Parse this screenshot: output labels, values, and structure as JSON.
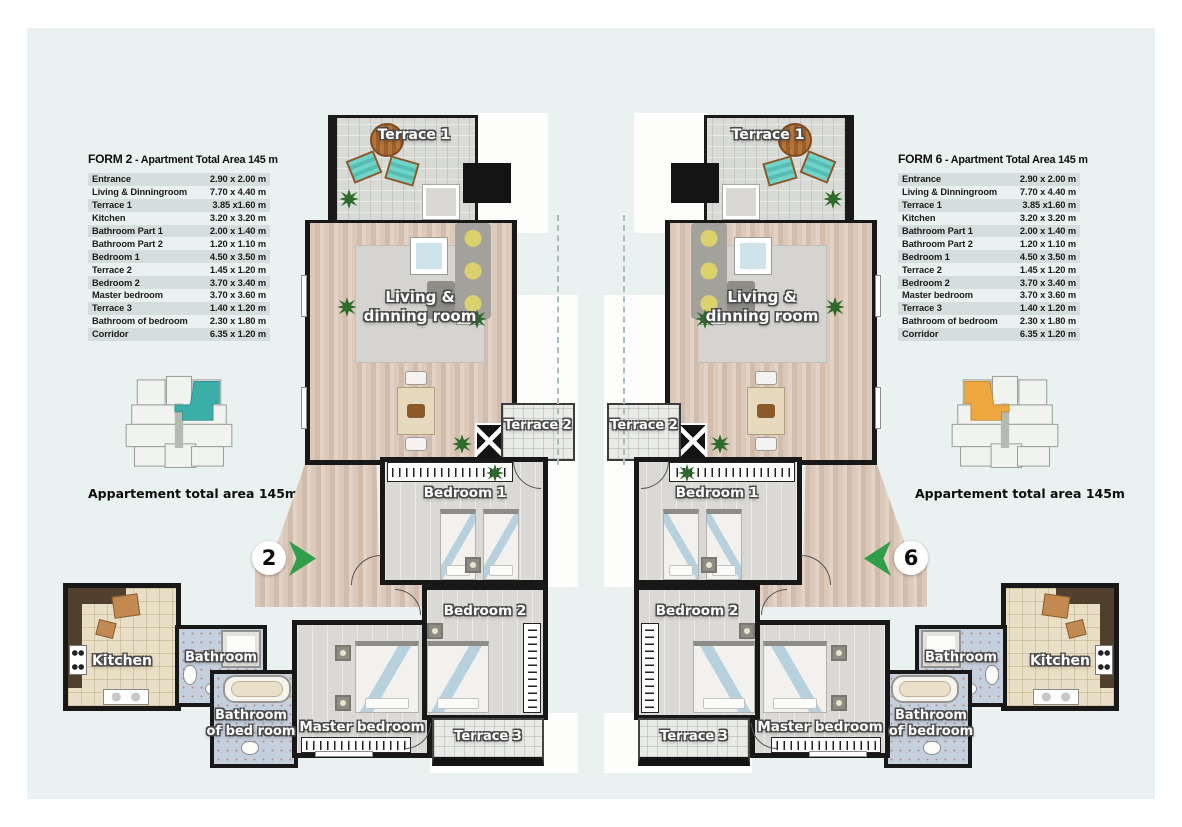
{
  "left_panel": {
    "form_label": "FORM 2",
    "form_title": "- Apartment Total Area 145 m",
    "map_caption": "Appartement total area 145m",
    "unit_badge": "2",
    "highlight_color": "#3aaea7",
    "rows": [
      {
        "label": "Entrance",
        "size": "2.90 x 2.00 m"
      },
      {
        "label": "Living & Dinningroom",
        "size": "7.70 x 4.40 m"
      },
      {
        "label": "Terrace 1",
        "size": "3.85 x1.60 m"
      },
      {
        "label": "Kitchen",
        "size": "3.20 x 3.20 m"
      },
      {
        "label": "Bathroom Part 1",
        "size": "2.00 x 1.40 m"
      },
      {
        "label": "Bathroom Part 2",
        "size": "1.20 x 1.10 m"
      },
      {
        "label": "Bedroom 1",
        "size": "4.50 x 3.50 m"
      },
      {
        "label": "Terrace 2",
        "size": "1.45 x 1.20 m"
      },
      {
        "label": "Bedroom 2",
        "size": "3.70 x 3.40 m"
      },
      {
        "label": "Master bedroom",
        "size": "3.70 x 3.60 m"
      },
      {
        "label": "Terrace 3",
        "size": "1.40 x 1.20 m"
      },
      {
        "label": "Bathroom of bedroom",
        "size": "2.30 x 1.80 m"
      },
      {
        "label": "Corridor",
        "size": "6.35 x 1.20 m"
      }
    ]
  },
  "right_panel": {
    "form_label": "FORM 6",
    "form_title": "- Apartment Total Area 145 m",
    "map_caption": "Appartement total area 145m",
    "unit_badge": "6",
    "highlight_color": "#eda73f",
    "rows": [
      {
        "label": "Entrance",
        "size": "2.90 x 2.00 m"
      },
      {
        "label": "Living & Dinningroom",
        "size": "7.70 x 4.40 m"
      },
      {
        "label": "Terrace 1",
        "size": "3.85 x1.60 m"
      },
      {
        "label": "Kitchen",
        "size": "3.20 x 3.20 m"
      },
      {
        "label": "Bathroom Part 1",
        "size": "2.00 x 1.40 m"
      },
      {
        "label": "Bathroom Part 2",
        "size": "1.20 x 1.10 m"
      },
      {
        "label": "Bedroom 1",
        "size": "4.50 x 3.50 m"
      },
      {
        "label": "Terrace 2",
        "size": "1.45 x 1.20 m"
      },
      {
        "label": "Bedroom 2",
        "size": "3.70 x 3.40 m"
      },
      {
        "label": "Master bedroom",
        "size": "3.70 x 3.60 m"
      },
      {
        "label": "Terrace 3",
        "size": "1.40 x 1.20 m"
      },
      {
        "label": "Bathroom of bedroom",
        "size": "2.30 x 1.80 m"
      },
      {
        "label": "Corridor",
        "size": "6.35 x 1.20 m"
      }
    ]
  },
  "plan": {
    "terrace1": "Terrace 1",
    "living1": "Living &",
    "living2": "dinning room",
    "terrace2": "Terrace 2",
    "bedroom1": "Bedroom 1",
    "bedroom2": "Bedroom 2",
    "master": "Master bedroom",
    "terrace3": "Terrace 3",
    "kitchen": "Kitchen",
    "bathroom": "Bathroom",
    "bathbed_l1": "Bathroom",
    "bathbed_l2": "of bed room",
    "bathbed_r1": "Bathroom",
    "bathbed_r2": "of bedroom"
  }
}
